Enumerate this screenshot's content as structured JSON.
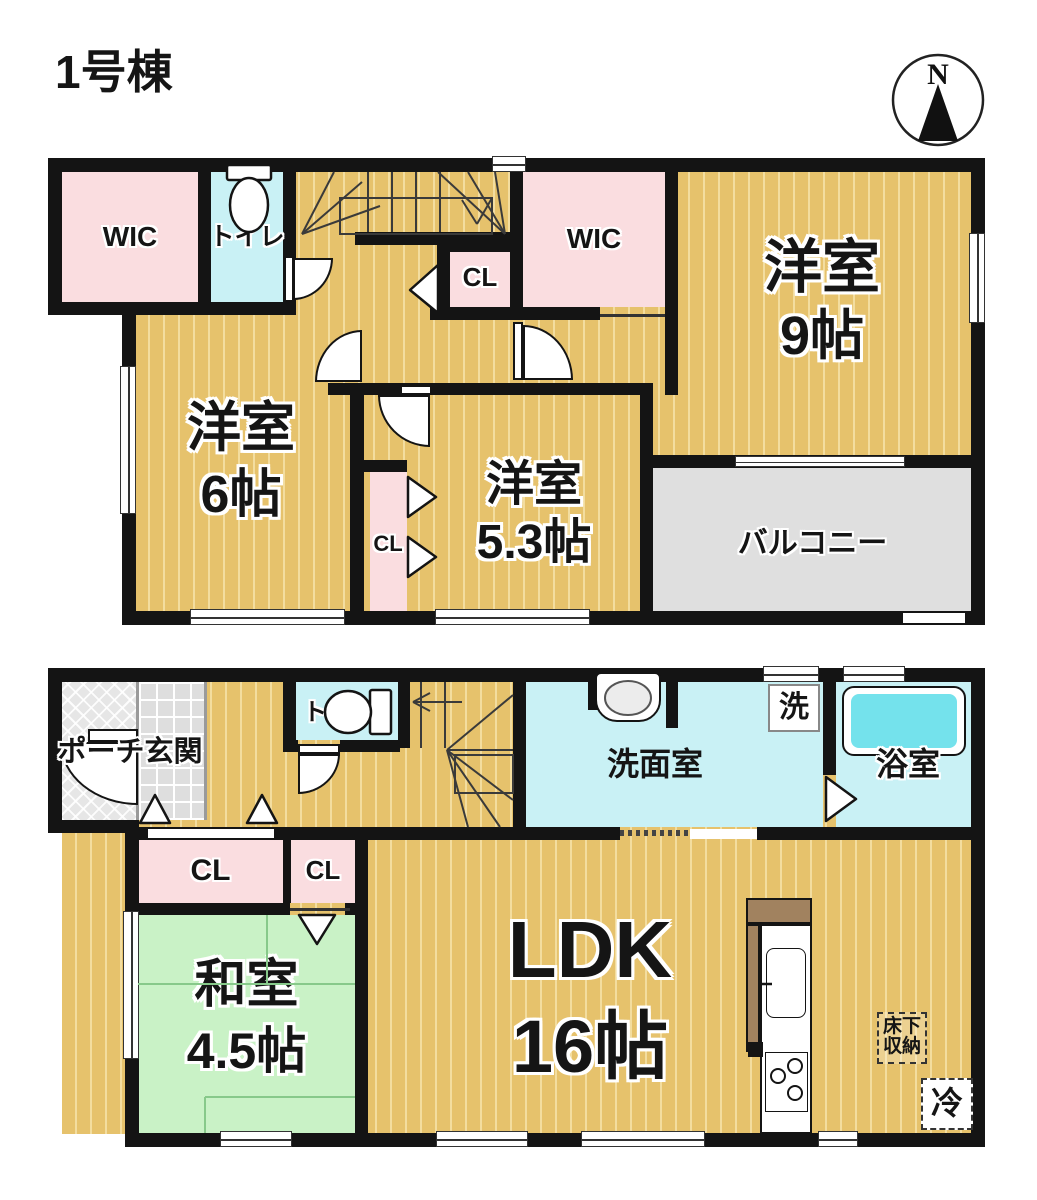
{
  "title": "1号棟",
  "compass": {
    "north_label": "N"
  },
  "floor_2f": {
    "wic_left": "WIC",
    "toilet": "トイレ",
    "hall_closet": "CL",
    "wic_right": "WIC",
    "western_room_9": {
      "name": "洋室",
      "size": "9帖"
    },
    "western_room_6": {
      "name": "洋室",
      "size": "6帖"
    },
    "western_room_53": {
      "name": "洋室",
      "size": "5.3帖"
    },
    "closet_53": "CL",
    "balcony": "バルコニー"
  },
  "floor_1f": {
    "porch_entrance": "ポーチ玄関",
    "toilet": "トイレ",
    "washroom": "洗面室",
    "washer": "洗",
    "bathroom": "浴室",
    "closet_1": "CL",
    "closet_2": "CL",
    "japanese_room": {
      "name": "和室",
      "size": "4.5帖"
    },
    "ldk": {
      "name": "LDK",
      "size": "16帖"
    },
    "underfloor_storage": {
      "line1": "床下",
      "line2": "収納"
    },
    "refrigerator": "冷"
  },
  "colors": {
    "wood_floor": "#e6c26c",
    "wood_stripe": "#f3dd9f",
    "closet_pink": "#fadde0",
    "water_cyan": "#c9f1f5",
    "bathtub_cyan": "#74e2ec",
    "tatami_green": "#c9f2c6",
    "balcony_gray": "#dfdfdf",
    "wall_black": "#141414",
    "kitchen_brown": "#a1825f"
  }
}
